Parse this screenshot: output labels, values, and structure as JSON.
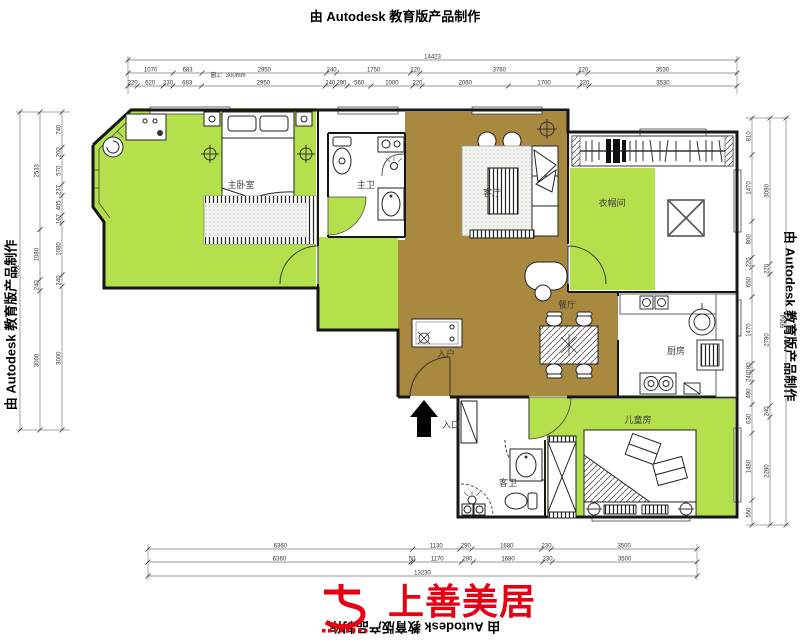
{
  "watermark": {
    "top": "由 Autodesk 教育版产品制作",
    "left": "由 Autodesk 教育版产品制作",
    "right": "由 Autodesk 教育版产品制作",
    "bottom": "由 Autodesk 教育版产品制作"
  },
  "logo": {
    "name": "上善美居",
    "color": "#e60012"
  },
  "annotation": {
    "sill_note": "窗1：300mm"
  },
  "rooms": {
    "master_bedroom": "主卧室",
    "master_bath": "主卫",
    "living": "客厅",
    "cloakroom": "衣帽间",
    "dining": "餐厅",
    "kitchen": "厨房",
    "kids_room": "儿童房",
    "guest_bath": "客卫",
    "entry_cabinet": "入户",
    "entrance": "入口"
  },
  "colors": {
    "floor_green": "#b4e04c",
    "floor_brown": "#a9883f",
    "wall": "#161616",
    "logo_red": "#e60012"
  },
  "dimensions": {
    "top": {
      "total": "14423",
      "row1": [
        "1070",
        "683",
        "2950",
        "240",
        "1750",
        "220",
        "3760",
        "220",
        "3530"
      ],
      "row2": [
        "220",
        "620",
        "230",
        "683",
        "2950",
        "240",
        "290",
        "560",
        "1000",
        "220",
        "2060",
        "1700",
        "220",
        "3530"
      ]
    },
    "bottom": {
      "total": "13230",
      "row1": [
        "6360",
        "1130",
        "290",
        "1680",
        "230",
        "3500"
      ],
      "row2": [
        "6360",
        "50",
        "1170",
        "290",
        "1680",
        "230",
        "3500"
      ]
    },
    "left": {
      "total": "6852",
      "outer": [
        "2533",
        "1080",
        "240",
        "3000"
      ],
      "inner": [
        "740",
        "200",
        "570",
        "237",
        "405",
        "167",
        "1080",
        "240",
        "3000"
      ]
    },
    "right": {
      "total": "9064",
      "outer": [
        "3080",
        "220",
        "2780",
        "240",
        "2280"
      ],
      "inner": [
        "810",
        "1470",
        "800",
        "220",
        "650",
        "1470",
        "180",
        "240",
        "490",
        "630",
        "1480",
        "550"
      ]
    }
  }
}
